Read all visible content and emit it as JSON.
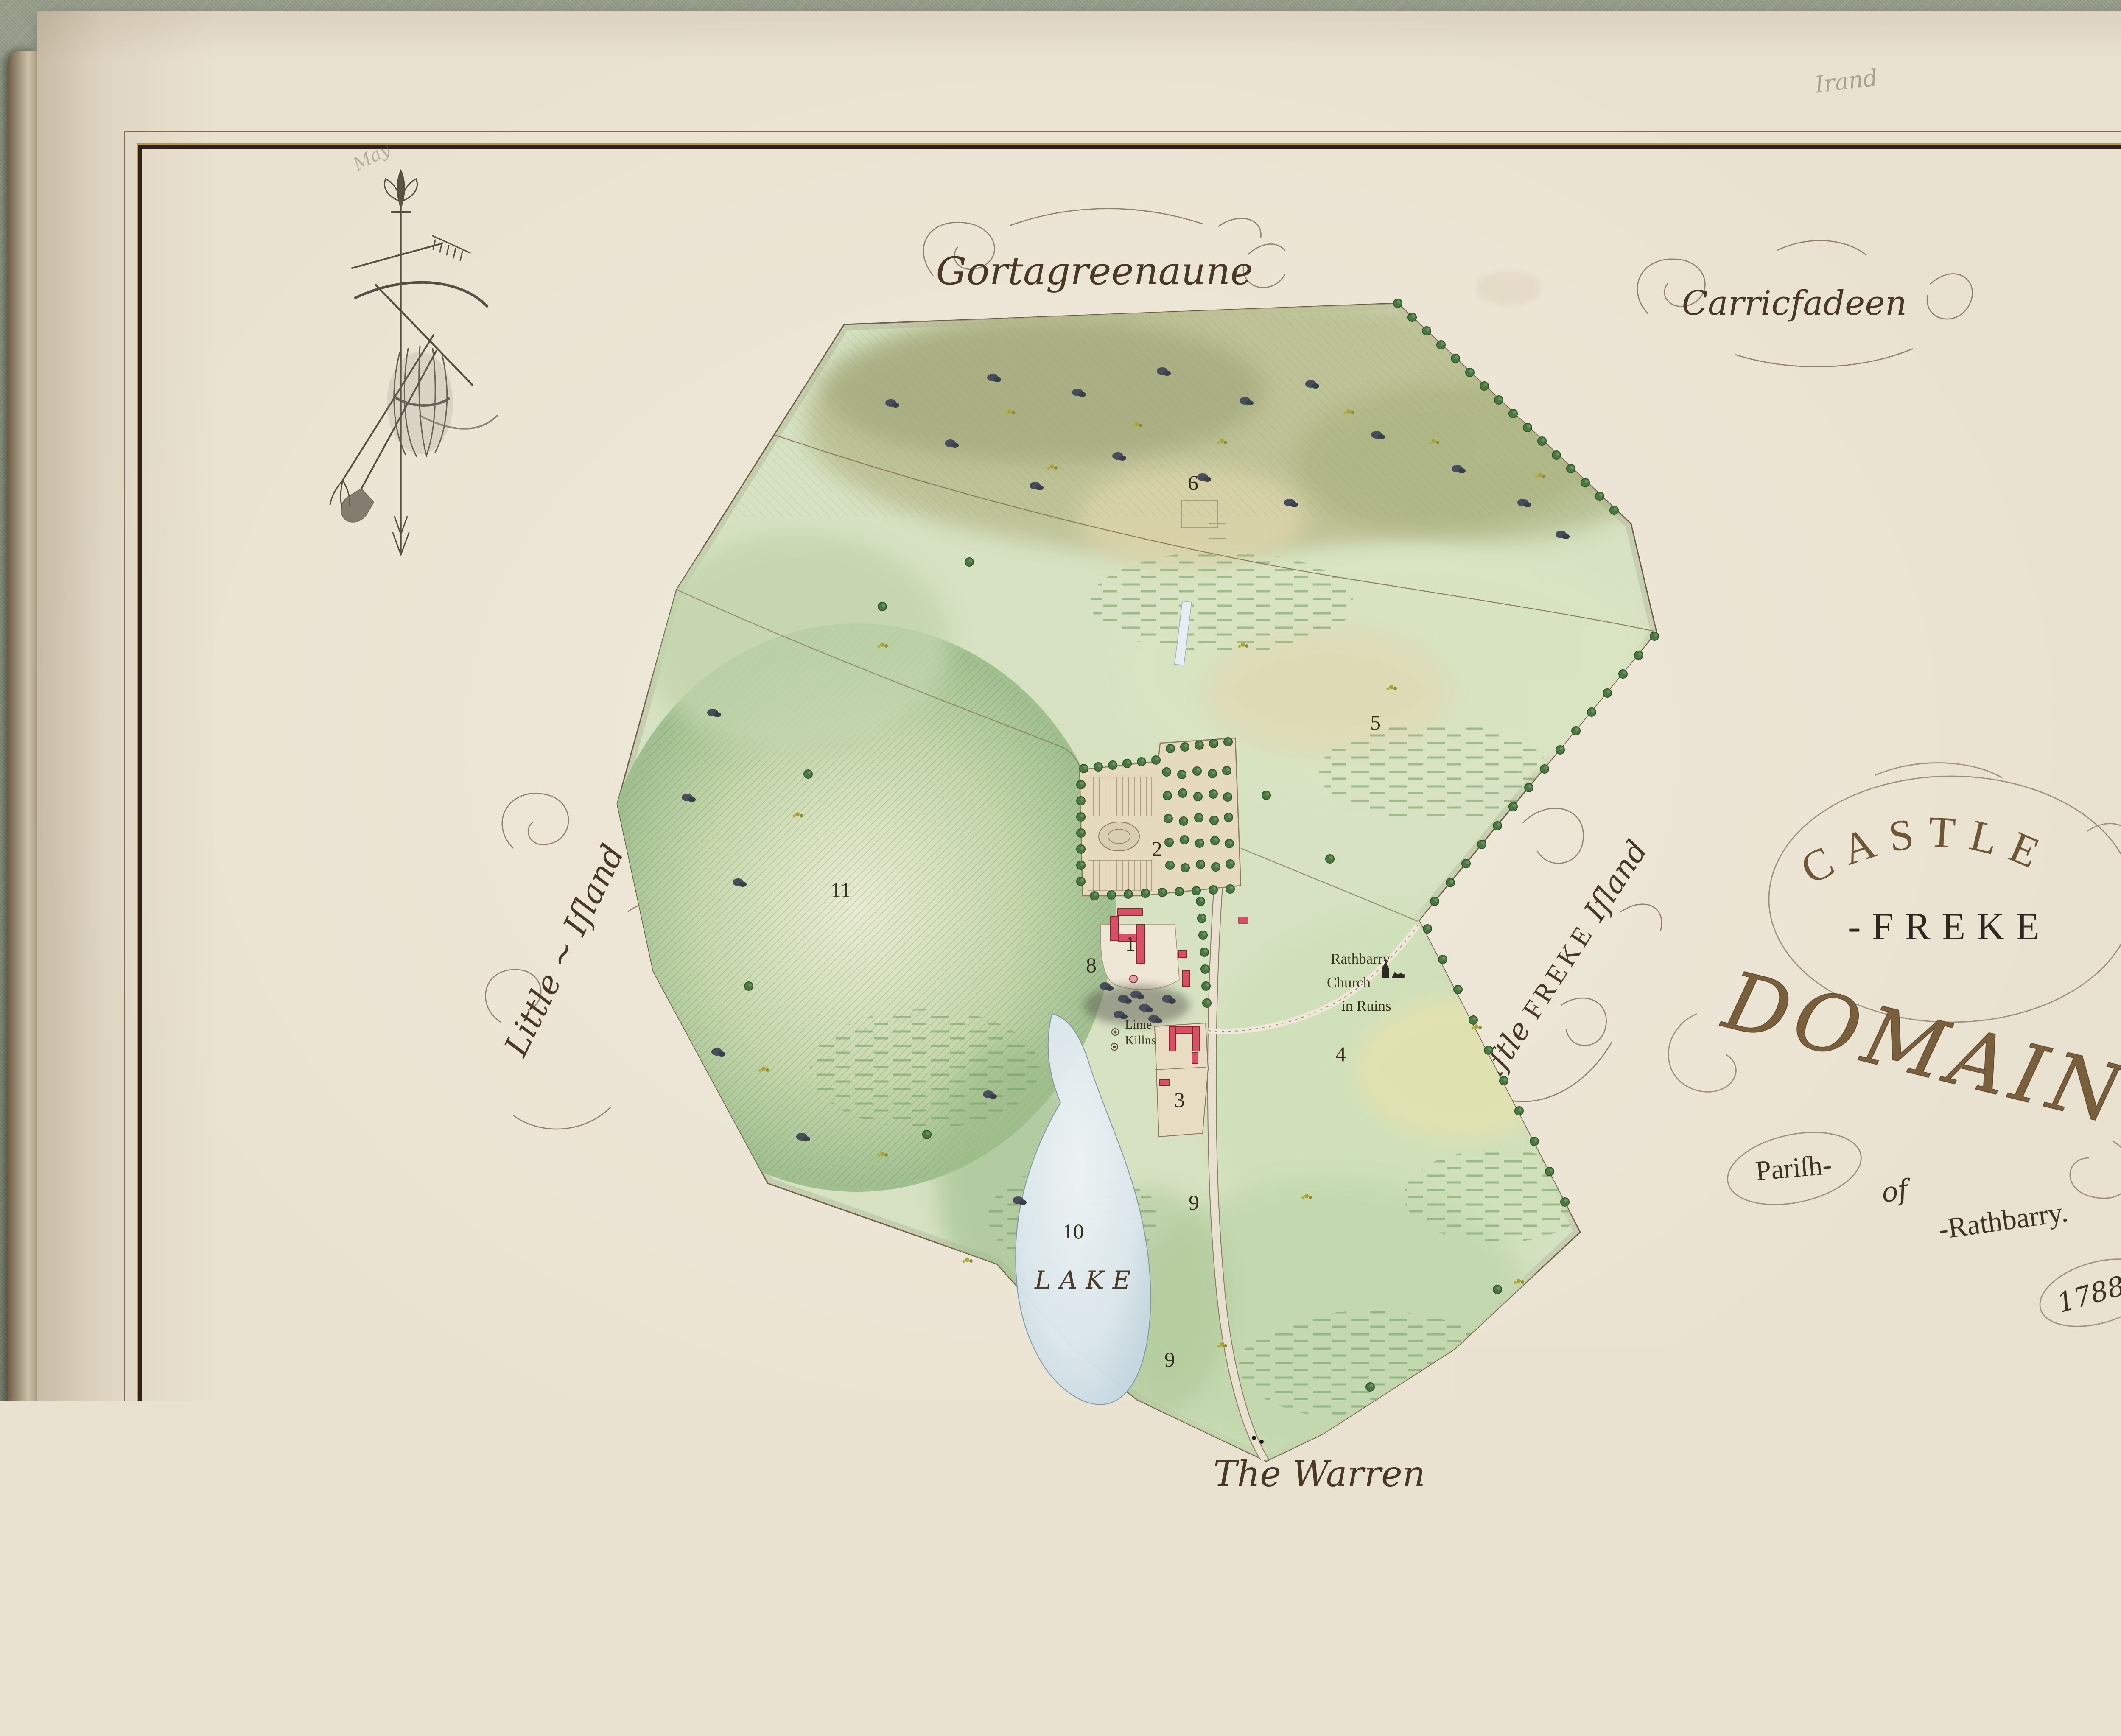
{
  "page": {
    "folio_number": "1",
    "pencil_note_top_right": "Irand",
    "pencil_note_top_left": "May"
  },
  "title_cartouche": {
    "line1": "CASTLE",
    "line2": "-FREKE",
    "line3": "DOMAIN",
    "line4": "Pariſh-",
    "line5": "of",
    "line6": "-Rathbarry.",
    "line7": "1788."
  },
  "townlands": {
    "top_center": "Gortagreenaune",
    "top_right": "Carricfadeen",
    "west": "Little ~ Iſland",
    "east_part1": "Caſtle ",
    "east_part2": "FREKE",
    "east_part3": " Iſland",
    "south": "The Warren"
  },
  "scale_bar": {
    "numeral": "XX",
    "caption": "Perches to an Inch",
    "ticks": [
      "0",
      "10",
      "20",
      "30",
      "40"
    ]
  },
  "map_labels": {
    "lake": "LAKE",
    "lime_kilns_1": "Lime",
    "lime_kilns_2": "Killns",
    "church_1": "Rathbarry",
    "church_2": "Church",
    "church_3": "in Ruins",
    "plots": {
      "p1": "1",
      "p2": "2",
      "p3": "3",
      "p4": "4",
      "p5": "5",
      "p6": "6",
      "p8": "8",
      "p9a": "9",
      "p9b": "9",
      "p10": "10",
      "p11": "11"
    }
  },
  "icons": {
    "north_ornament": "north-arrow-with-fleur-de-lis-and-farm-tools",
    "church_icon": "church-in-ruins",
    "scale_bar_icon": "surveyors-scale-bar"
  },
  "footer": {
    "copyright": "© 2019 The Dean and Chapter of St. Fachtna's Cathedral, Ross. Corpus of Electronic Texts (CELT), University College Cork."
  },
  "colors": {
    "carpet": "#8f9681",
    "page": "#eae2d0",
    "frame_dark": "#2b2219",
    "frame_gold": "#bd964a",
    "ink": "#4a3826",
    "map_green": "#d6e2c2",
    "lake_blue": "#d8e5ec",
    "building_red": "#d94f63",
    "tree_green": "#4a7742"
  }
}
